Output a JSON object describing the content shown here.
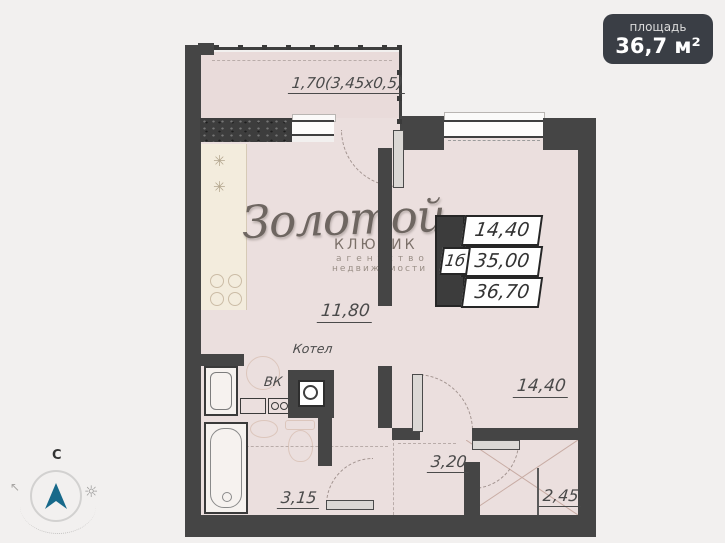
{
  "area_badge": {
    "label": "площадь",
    "value": "36,7 м²"
  },
  "watermark": {
    "brand": "Золотой",
    "sub": "КЛЮЧИК",
    "tagline1": "агентство",
    "tagline2": "недвижимости"
  },
  "unit_table": {
    "unit": "1б",
    "values": [
      "14,40",
      "35,00",
      "36,70"
    ]
  },
  "plan_labels": {
    "balcony_dimension": "1,70(3,45x0,5)",
    "kitchen_living_area": "11,80",
    "boiler": "Котел",
    "utility": "ВК",
    "bedroom_area": "14,40",
    "hallway_area": "3,20",
    "bathroom_area": "3,15",
    "wardrobe_area": "2,45"
  },
  "compass": {
    "north": "С"
  },
  "icons": {
    "sun": "☼",
    "northwest_arrow": "↖",
    "burner": "✳"
  },
  "colors": {
    "wall": "#454545",
    "floor": "#ebdfde",
    "badge_bg": "#3a3e45",
    "compass_arrow": "#17698a"
  }
}
